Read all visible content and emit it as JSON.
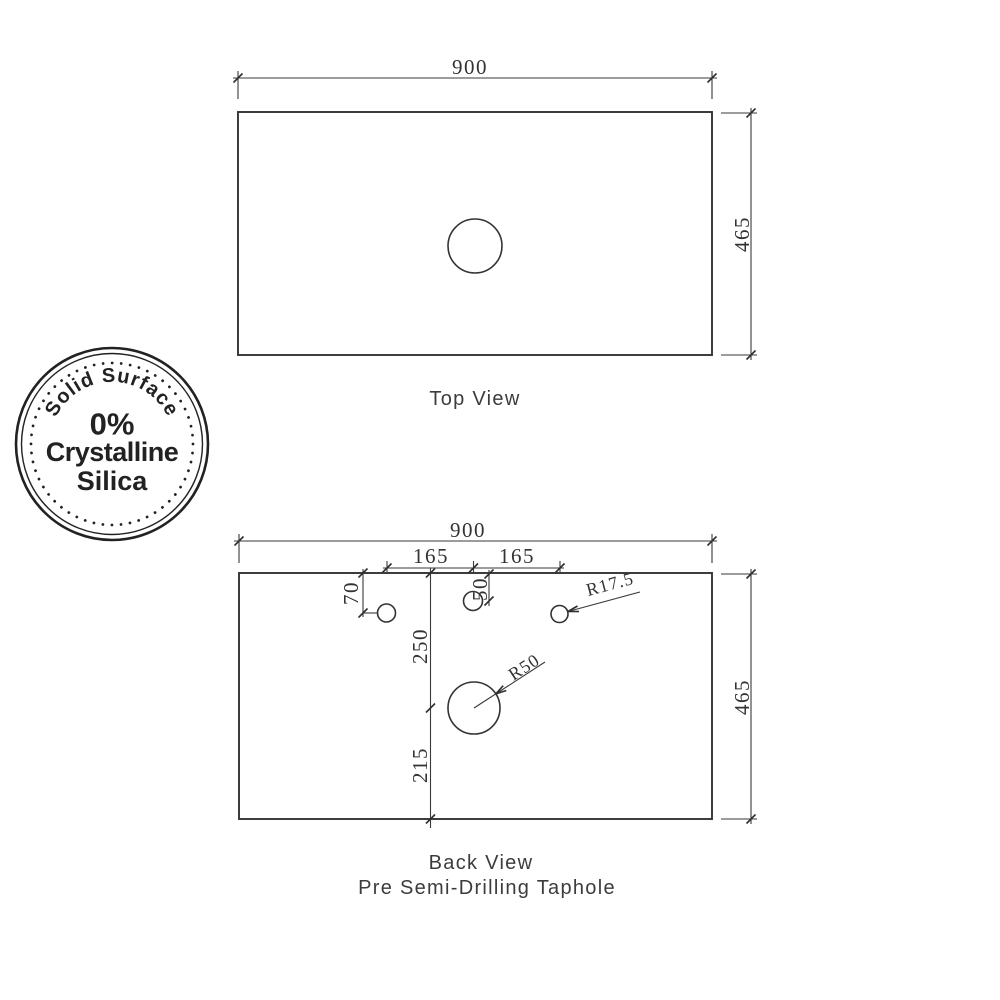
{
  "badge": {
    "arc_text": "Solid Surface",
    "line1": "0%",
    "line2": "Crystalline",
    "line3": "Silica"
  },
  "top_view": {
    "label": "Top View",
    "width_dim": "900",
    "height_dim": "465"
  },
  "back_view": {
    "label": "Back View",
    "sublabel": "Pre Semi-Drilling Taphole",
    "width_dim": "900",
    "height_dim": "465",
    "left_spacing_dim": "165",
    "right_spacing_dim": "165",
    "left_hole_offset_dim": "70",
    "center_hole_offset_dim": "50",
    "taphole_radius_label": "R17.5",
    "drain_radius_label": "R50",
    "upper_offset_dim": "250",
    "lower_offset_dim": "215"
  },
  "colors": {
    "ink": "#333333",
    "badge_ink": "#222222",
    "background": "#ffffff"
  }
}
